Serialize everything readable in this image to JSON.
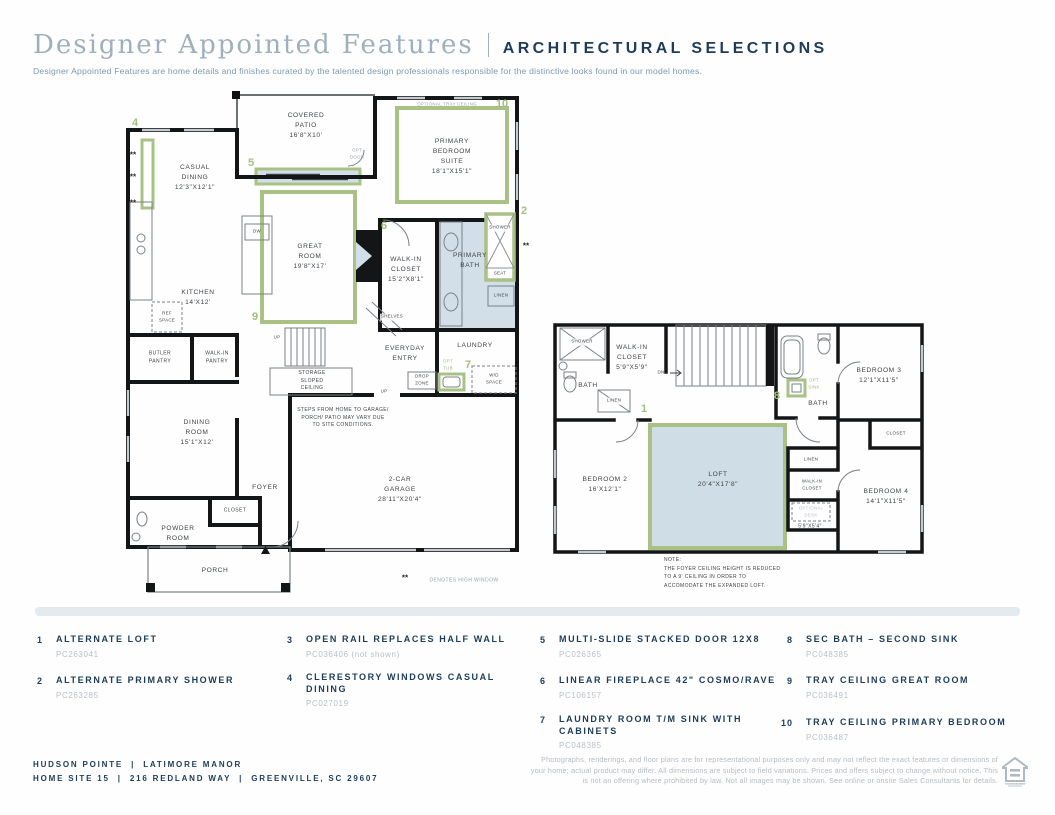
{
  "header": {
    "title_serif": "Designer Appointed Features",
    "title_caps": "ARCHITECTURAL SELECTIONS",
    "subtitle": "Designer Appointed Features are home details and finishes curated by the talented design professionals responsible for the distinctive looks found in our model homes."
  },
  "misc": {
    "stars": "**"
  },
  "plan1": {
    "labels": {
      "covered_patio": "COVERED\nPATIO\n16'8\"X10'",
      "opt_tray_primary": "OPTIONAL TRAY CEILING",
      "primary_suite": "PRIMARY\nBEDROOM\nSUITE\n18'1\"X15'1\"",
      "casual_dining": "CASUAL\nDINING\n12'3\"X12'1\"",
      "great_room": "GREAT\nROOM\n19'8\"X17'",
      "opt_door": "OPT\nDOOR",
      "walk_in_closet": "WALK-IN\nCLOSET\n15'2\"X8'1\"",
      "primary_bath": "PRIMARY\nBATH",
      "shower": "SHOWER",
      "seat": "SEAT",
      "linen": "LINEN",
      "kitchen": "KITCHEN\n14'X12'",
      "dw": "DW",
      "ref_space": "REF\nSPACE",
      "butler_pantry": "BUTLER\nPANTRY",
      "walk_in_pantry": "WALK-IN\nPANTRY",
      "up_stairs": "UP",
      "storage": "STORAGE\nSLOPED\nCEILING",
      "shelves": "SHELVES",
      "everyday_entry": "EVERYDAY\nENTRY",
      "laundry": "LAUNDRY",
      "opt_tub": "OPT\nTUB",
      "drop_zone": "DROP\nZONE",
      "wd_space": "W/D\nSPACE",
      "up_garage": "UP",
      "steps_note": "STEPS FROM HOME TO GARAGE/\nPORCH/ PATIO MAY VARY DUE\nTO SITE CONDITIONS.",
      "garage": "2-CAR\nGARAGE\n28'11\"X20'4\"",
      "dining_room": "DINING\nROOM\n15'1\"X12'",
      "foyer": "FOYER",
      "closet": "CLOSET",
      "powder_room": "POWDER\nROOM",
      "porch": "PORCH",
      "denotes_high_window": "DENOTES HIGH WINDOW"
    },
    "callouts": {
      "n2": "2",
      "n4": "4",
      "n5": "5",
      "n6": "6",
      "n7": "7",
      "n9": "9",
      "n10": "10"
    }
  },
  "plan2": {
    "labels": {
      "shower": "SHOWER",
      "wic_upper": "WALK-IN\nCLOSET\n5'9\"X5'9\"",
      "bath_left": "BATH",
      "linen_up": "LINEN",
      "dn": "DN",
      "opt_sink": "OPT\nSINK",
      "bath_right": "BATH",
      "bedroom3": "BEDROOM 3\n12'1\"X11'5\"",
      "closet3": "CLOSET",
      "loft": "LOFT\n20'4\"X17'8\"",
      "bedroom2": "BEDROOM 2\n16'X12'1\"",
      "linen_low": "LINEN",
      "wic_lower": "WALK-IN\nCLOSET",
      "optional_desk": "OPTIONAL\nDESK",
      "desk_dims": "5'9\"X5'4\"",
      "bedroom4": "BEDROOM 4\n14'1\"X11'5\"",
      "note": "NOTE:\nTHE FOYER CEILING HEIGHT IS REDUCED\nTO A 9' CEILING IN ORDER TO\nACCOMODATE THE EXPANDED LOFT."
    },
    "callouts": {
      "n1": "1",
      "n8": "8"
    }
  },
  "legend": {
    "items": [
      {
        "num": "1",
        "title": "ALTERNATE LOFT",
        "code": "PC263041"
      },
      {
        "num": "2",
        "title": "ALTERNATE PRIMARY SHOWER",
        "code": "PC263285"
      },
      {
        "num": "3",
        "title": "OPEN RAIL REPLACES HALF WALL",
        "code": "PC036406 (not shown)"
      },
      {
        "num": "4",
        "title": "CLERESTORY WINDOWS CASUAL\nDINING",
        "code": "PC027019"
      },
      {
        "num": "5",
        "title": "MULTI-SLIDE STACKED DOOR 12X8",
        "code": "PC026365"
      },
      {
        "num": "6",
        "title": "LINEAR FIREPLACE 42\" COSMO/RAVE",
        "code": "PC106157"
      },
      {
        "num": "7",
        "title": "LAUNDRY ROOM T/M SINK WITH\nCABINETS",
        "code": "PC048385"
      },
      {
        "num": "8",
        "title": "SEC BATH – SECOND SINK",
        "code": "PC048385"
      },
      {
        "num": "9",
        "title": "TRAY CEILING GREAT ROOM",
        "code": "PC036491"
      },
      {
        "num": "10",
        "title": "TRAY CEILING PRIMARY BEDROOM",
        "code": "PC036487"
      }
    ]
  },
  "footer": {
    "community_line": "HUDSON POINTE  |  LATIMORE MANOR",
    "address_line": "HOME SITE 15  |  216 REDLAND WAY  |  GREENVILLE, SC 29607",
    "disclaimer": "Photographs, renderings, and floor plans are for representational purposes only and may not reflect the exact features or dimensions of your home; actual product may differ. All dimensions are subject to field variations. Prices and offers subject to change without notice. This is not an offering where prohibited by law. Not all images may be shown. See online or onsite Sales Consultants for details."
  }
}
